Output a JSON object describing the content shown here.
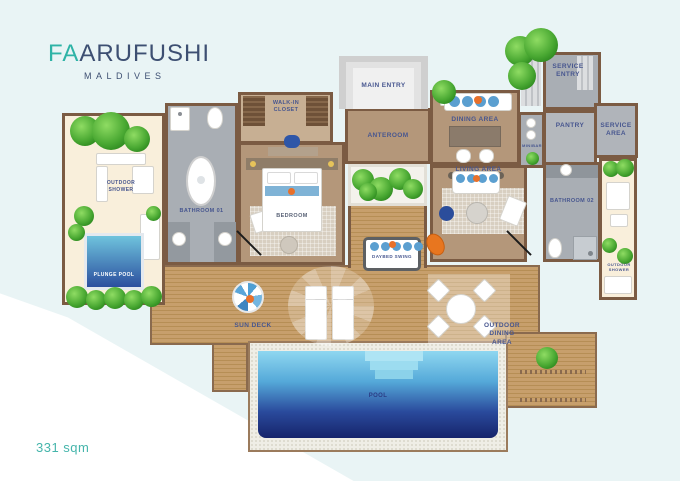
{
  "logo": {
    "brand_start": "FA",
    "brand_end": "ARUFUSHI",
    "subtitle": "MALDIVES"
  },
  "footer": {
    "area": "331 sqm"
  },
  "floorplan": {
    "labels": {
      "walk_in_closet": "WALK-IN CLOSET",
      "main_entry": "MAIN ENTRY",
      "anteroom": "ANTEROOM",
      "service_entry": "SERVICE ENTRY",
      "pantry": "PANTRY",
      "minibar": "MINIBAR",
      "service_area": "SERVICE AREA",
      "dining_area": "DINING AREA",
      "living_area": "LIVING AREA",
      "bedroom": "BEDROOM",
      "bathroom_01": "BATHROOM 01",
      "bathroom_02": "BATHROOM 02",
      "outdoor_shower": "OUTDOOR SHOWER",
      "plunge_pool": "PLUNGE POOL",
      "sun_deck": "SUN DECK",
      "daybed_swing": "DAYBED SWING",
      "outdoor_dining": "OUTDOOR DINING AREA",
      "pool": "POOL"
    },
    "colors": {
      "accent_teal": "#2eb3a6",
      "label_navy": "#47568f",
      "wall_brown": "#7b5b43",
      "deck_wood": "#c79f6c",
      "courtyard_sand": "#f9efdb",
      "bathroom_grey": "#a9aeb4",
      "interior_tan": "#b4977a",
      "pool_light": "#8fd7f0",
      "pool_dark": "#16246b",
      "plant_green": "#49a832",
      "cushion_blue": "#5b9fd0",
      "accent_orange": "#e8702a"
    }
  }
}
